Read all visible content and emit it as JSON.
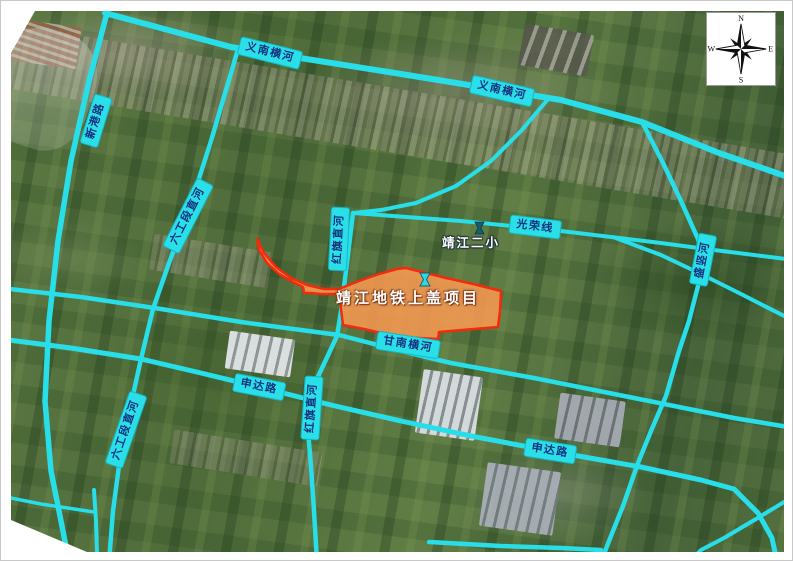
{
  "map": {
    "project": {
      "name": "靖江地铁上盖项目"
    },
    "school": {
      "name": "靖江二小"
    },
    "labels": [
      {
        "id": "yinan-henghe-1",
        "type": "river",
        "text": "义南横河"
      },
      {
        "id": "yinan-henghe-2",
        "type": "river",
        "text": "义南横河"
      },
      {
        "id": "xingang-road",
        "type": "road",
        "text": "新港路"
      },
      {
        "id": "liugongduan-zhihe-upper",
        "type": "river",
        "text": "六工段直河"
      },
      {
        "id": "hongqi-zhihe-upper",
        "type": "river",
        "text": "红旗直河"
      },
      {
        "id": "guangrong-line",
        "type": "road",
        "text": "光荣线"
      },
      {
        "id": "gannan-henghe",
        "type": "river",
        "text": "甘南横河"
      },
      {
        "id": "shenda-road-west",
        "type": "road",
        "text": "申达路"
      },
      {
        "id": "shenda-road-east",
        "type": "road",
        "text": "申达路"
      },
      {
        "id": "liugongduan-zhihe-lower",
        "type": "river",
        "text": "六工段直河"
      },
      {
        "id": "hongqi-zhihe-lower",
        "type": "river",
        "text": "红旗直河"
      },
      {
        "id": "shengshu-he",
        "type": "river",
        "text": "盛竖河"
      }
    ],
    "compass": {
      "north": "N",
      "east": "E",
      "south": "S",
      "west": "W"
    },
    "colors": {
      "line_cyan": "#28dfe9",
      "label_background": "#2bdfe9",
      "label_text": "#14327e",
      "project_fill": "#f79a52",
      "project_border": "#f42a0c",
      "poi_icon_cyan": "#2fd9e4"
    }
  }
}
